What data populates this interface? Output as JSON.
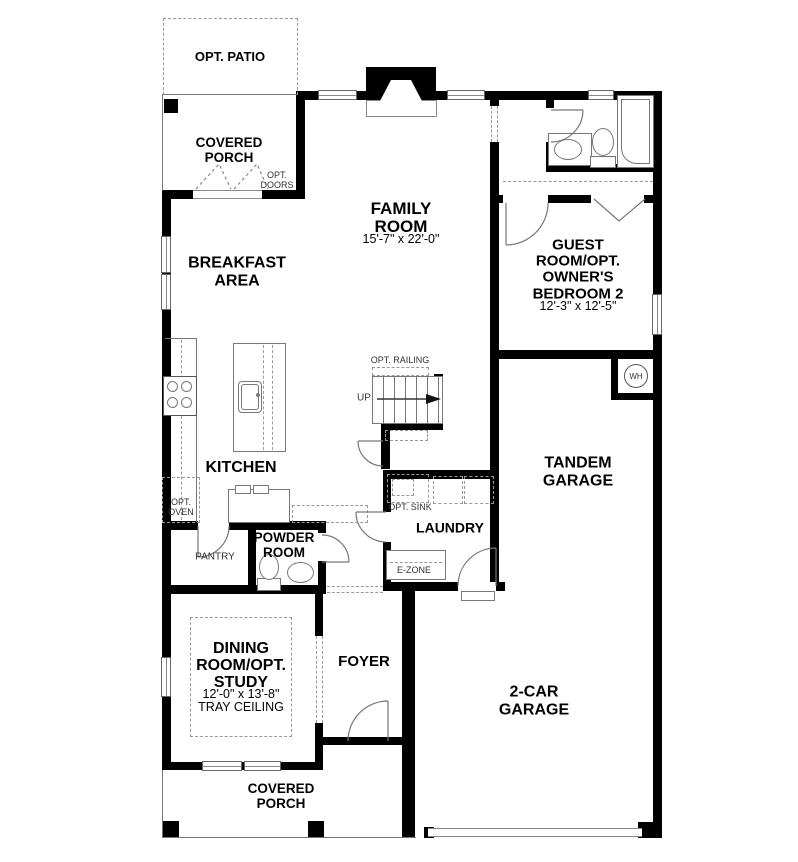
{
  "plan": {
    "patio": {
      "label": "OPT. PATIO"
    },
    "porch_top": {
      "label": "COVERED\nPORCH",
      "doors_label": "OPT.\nDOORS"
    },
    "family_room": {
      "label": "FAMILY\nROOM",
      "dims": "15'-7\" x 22'-0\""
    },
    "breakfast": {
      "label": "BREAKFAST\nAREA"
    },
    "guest_room": {
      "label": "GUEST\nROOM/OPT.\nOWNER'S\nBEDROOM 2",
      "dims": "12'-3\" x 12'-5\""
    },
    "kitchen": {
      "label": "KITCHEN",
      "opt_oven": "OPT.\nOVEN",
      "pantry": "PANTRY"
    },
    "powder": {
      "label": "POWDER\nROOM"
    },
    "stairs": {
      "railing": "OPT. RAILING",
      "up": "UP"
    },
    "laundry": {
      "label": "LAUNDRY",
      "opt_sink": "OPT. SINK",
      "ezone": "E-ZONE"
    },
    "tandem_garage": {
      "label": "TANDEM\nGARAGE"
    },
    "water_heater": {
      "label": "WH"
    },
    "dining": {
      "label": "DINING\nROOM/OPT.\nSTUDY",
      "dims": "12'-0\" x 13'-8\"",
      "note": "TRAY CEILING"
    },
    "foyer": {
      "label": "FOYER"
    },
    "garage": {
      "label": "2-CAR\nGARAGE"
    },
    "porch_bottom": {
      "label": "COVERED\nPORCH"
    }
  },
  "colors": {
    "wall": "#000000",
    "line": "#777777",
    "dashed": "#999999",
    "text": "#000000"
  }
}
